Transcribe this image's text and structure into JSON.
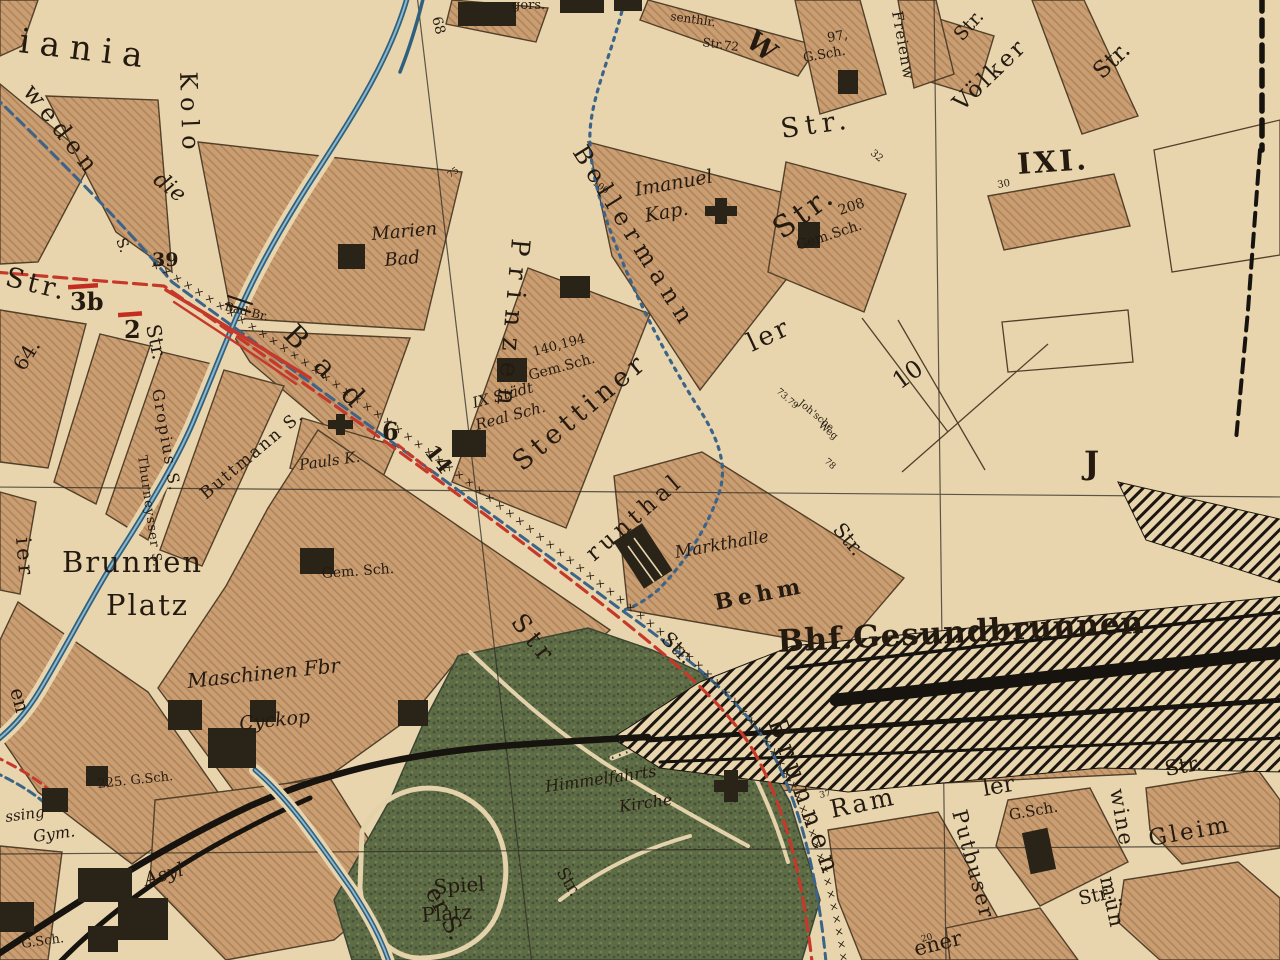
{
  "map": {
    "colors": {
      "paper": "#e8d5ae",
      "block": "#c99e73",
      "block_hatch": "#b2845a",
      "outline": "#53402a",
      "park_green": "#5e6c46",
      "park_dark": "#44523c",
      "river_blue": "#2f617e",
      "river_light": "#8fb7cc",
      "boundary_blue": "#3c6488",
      "tram_red": "#c5392b",
      "route_marks_orange": "#a3622a",
      "rail_black": "#1b160f",
      "text_dark": "#241a10",
      "text_red": "#c22d20",
      "text_blue": "#2b5f8a",
      "text_brown": "#b06a28"
    },
    "labels": {
      "streets": {
        "iania": "iania",
        "weden": "weden",
        "kolo": "Kolo",
        "kolonie_s": "S.",
        "str": "Str.",
        "str_plain": "Str",
        "bad": "Bad",
        "bad_bruecke": "Bad Br.",
        "die": "die",
        "brunnen": "Brunnen",
        "prinzen": "Prinzen",
        "stettiner": "Stettiner",
        "bellermann": "Bellermann",
        "gruenthaler_frag": "runthal",
        "ler": "ler",
        "behm": "Behm",
        "ram": "Ram",
        "ramler_frag": "ler",
        "putbuser": "Putbuser",
        "swinemuender_frag1": "wine",
        "swinemuender_frag2": "mün",
        "gleim": "Gleim",
        "ener_frag": "ener",
        "er_s_frag": "er S.",
        "voelker": "Völker",
        "freienwalder_frag": "Freienw",
        "wriezener_frag": "W",
        "ier_frag": "ier",
        "en_frag": "en",
        "gropius": "Gropius S.",
        "thurneysser": "Thurneysser S.",
        "buttmann": "Buttmann S.",
        "joh_weg1": "Joh'sche",
        "joh_weg2": "Weg",
        "rosenthaler_frag": "senthlr.",
        "str72": "Str.72",
        "gors_frag": "gors."
      },
      "places": {
        "marien1": "Marien",
        "marien2": "Bad",
        "imanuel1": "Imanuel",
        "imanuel2": "Kap.",
        "pump_st": "Pump St.",
        "gem_sch": "Gem.Sch.",
        "gem_sch_spaced": "Gem. Sch.",
        "staedt1": "IX Städt",
        "staedt2": "Real Sch.",
        "pauls": "Pauls K.",
        "markthalle": "Markthalle",
        "station": "Bhf.Gesundbrunnen",
        "brunnen_platz1": "Brunnen",
        "brunnen_platz2": "Platz",
        "maschinen1": "Maschinen Fbr",
        "maschinen2": "Cyckop",
        "lessing_frag": "ssing",
        "gym": "Gym.",
        "asyl": "Asyl",
        "g_sch": "G.Sch.",
        "sch225": "225. G.Sch.",
        "himmelfahrts1": "Himmelfahrts",
        "himmelfahrts2": "Kirche",
        "spiel1": "Spiel",
        "spiel2": "Platz"
      },
      "numbers": {
        "n64": "64.",
        "n68": "68",
        "n75": "75",
        "n100": "100",
        "n7379": "73.79",
        "n78": "78",
        "n32": "32",
        "n30": "30",
        "n37": "37",
        "n20": "20",
        "n97": "97,",
        "n208": "208",
        "n140": "140,194",
        "n10": "10"
      },
      "districts": {
        "ixi": "IXI.",
        "j": "J"
      },
      "routes": {
        "n39": "39",
        "n3b": "3b",
        "n2": "2",
        "n6": "6",
        "n14": "14",
        "x_marks": "× × × × × × × × × × × × × × × × × × × × × × × × × × × × × × × × × × × × × × × × × × × × × × × × × × × × × × × × × × × × × × × × × × × × × × × × × × × × × × × ×"
      }
    }
  }
}
